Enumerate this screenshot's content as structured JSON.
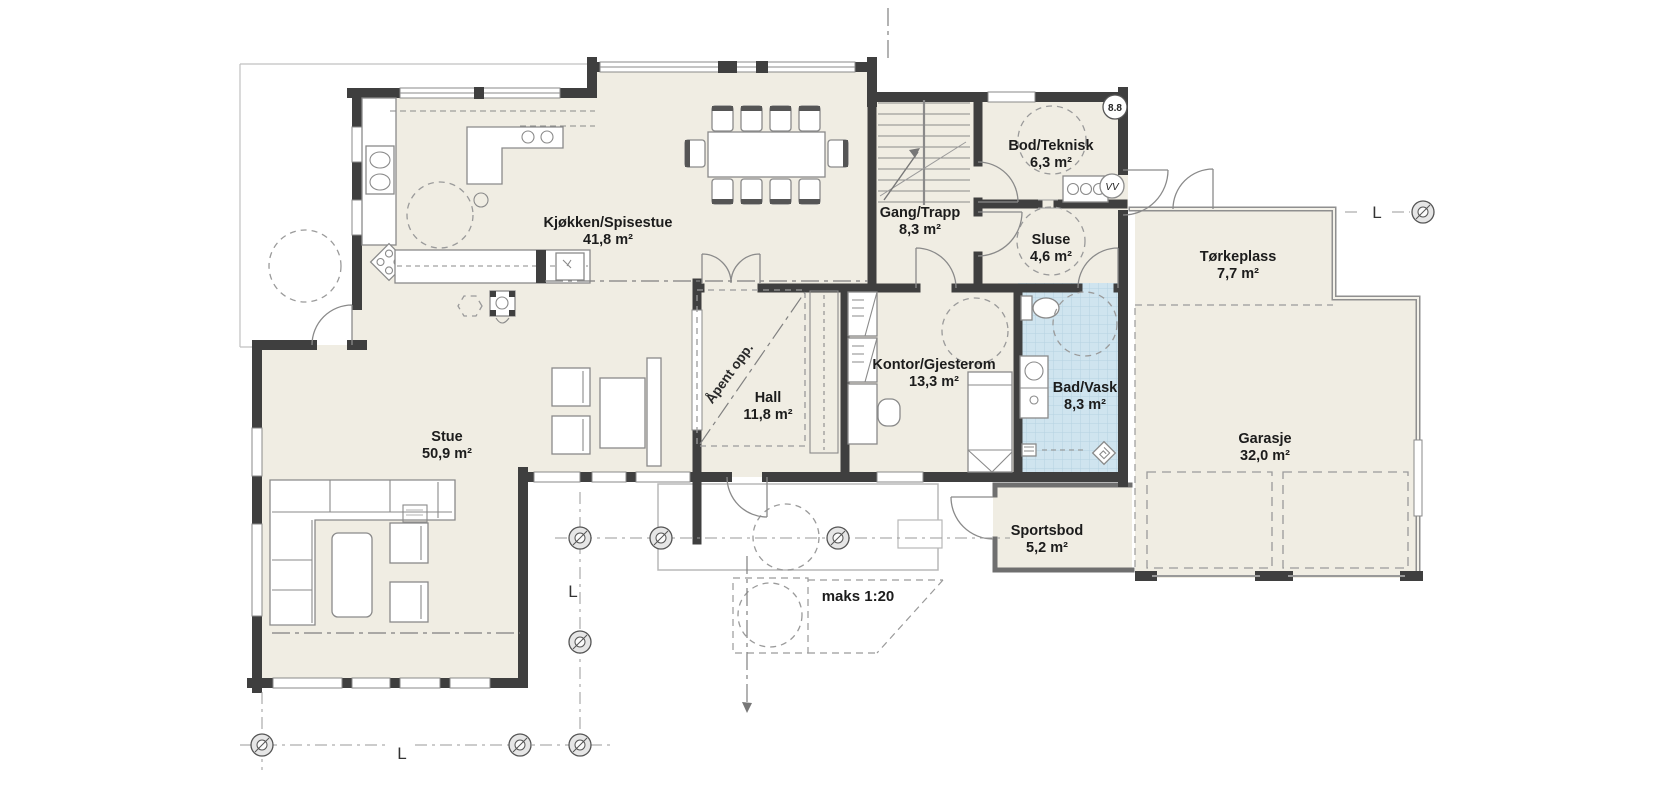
{
  "rooms": [
    {
      "id": "kjokken",
      "name": "Kjøkken/Spisestue",
      "area": "41,8 m²"
    },
    {
      "id": "bod",
      "name": "Bod/Teknisk",
      "area": "6,3 m²"
    },
    {
      "id": "gang",
      "name": "Gang/Trapp",
      "area": "8,3 m²"
    },
    {
      "id": "sluse",
      "name": "Sluse",
      "area": "4,6 m²"
    },
    {
      "id": "torkeplass",
      "name": "Tørkeplass",
      "area": "7,7 m²"
    },
    {
      "id": "kontor",
      "name": "Kontor/Gjesterom",
      "area": "13,3 m²"
    },
    {
      "id": "hall",
      "name": "Hall",
      "area": "11,8 m²"
    },
    {
      "id": "bad",
      "name": "Bad/Vask",
      "area": "8,3 m²"
    },
    {
      "id": "stue",
      "name": "Stue",
      "area": "50,9 m²"
    },
    {
      "id": "garasje",
      "name": "Garasje",
      "area": "32,0 m²"
    },
    {
      "id": "sportsbod",
      "name": "Sportsbod",
      "area": "5,2 m²"
    }
  ],
  "annotations": {
    "open_above": "Åpent opp.",
    "ramp": "maks 1:20",
    "section_marker": "8.8",
    "water_heater_label": "VV",
    "axis_label": "L"
  },
  "colors": {
    "wall": "#3f3f3f",
    "floor": "#f0ede3",
    "bath_floor": "#cfe4ef",
    "bath_grid": "#b6d2e2",
    "line": "#8a8a8a",
    "text": "#1c1c1c"
  }
}
